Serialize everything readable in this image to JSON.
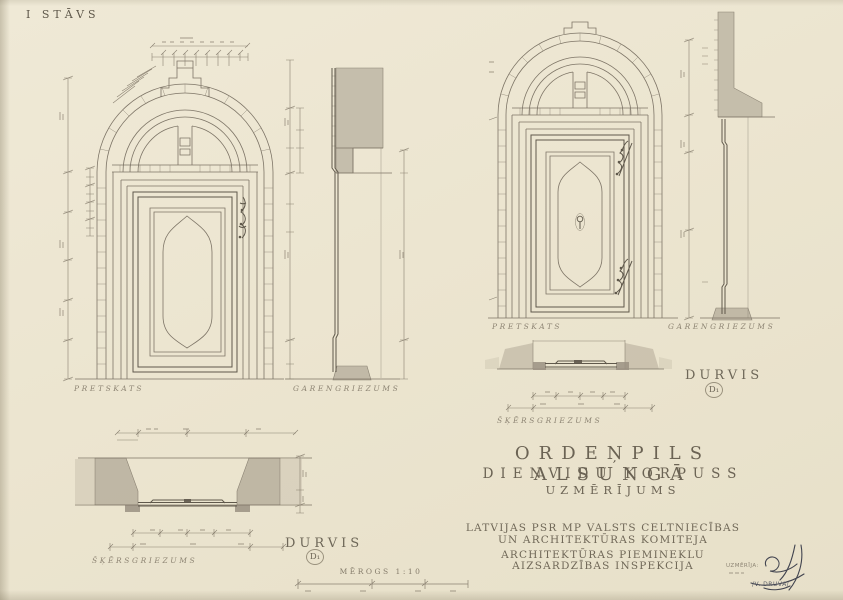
{
  "sheet": {
    "floor_label": "I STĀVS",
    "scale_label": "MĒROGS 1:10",
    "colors": {
      "paper": "#ebe4ce",
      "ink": "#766d5e",
      "ink_dark": "#5e574a",
      "shading": "#b6ae9c",
      "label_ink": "#8d8473",
      "signature_ink": "#41434f"
    }
  },
  "door1": {
    "elevation_label": "PRETSKATS",
    "section_label": "GARENGRIEZUMS",
    "plan_label": "ŠĶĒRSGRIEZUMS",
    "name_label": "DURVIS",
    "mark": "D₁"
  },
  "door2": {
    "elevation_label": "PRETSKATS",
    "section_label": "GARENGRIEZUMS",
    "plan_label": "ŠĶĒRSGRIEZUMS",
    "name_label": "DURVIS",
    "mark": "D₁"
  },
  "title_block": {
    "line1": "ORDEŅPILS ALSUNGĀ",
    "line2": "DIENVIDU KORPUSS",
    "line3": "UZMĒRĪJUMS"
  },
  "committee": {
    "line1": "LATVIJAS PSR MP VALSTS CELTNIECĪBAS",
    "line2": "UN ARCHITEKTŪRAS KOMITEJA",
    "line3": "ARCHITEKTŪRAS PIEMINEKLU",
    "line4": "AIZSARDZĪBAS INSPEKCIJA"
  },
  "signature": {
    "caption": "UZMĒRĪJA:",
    "name": "/V. DRUVA/"
  }
}
